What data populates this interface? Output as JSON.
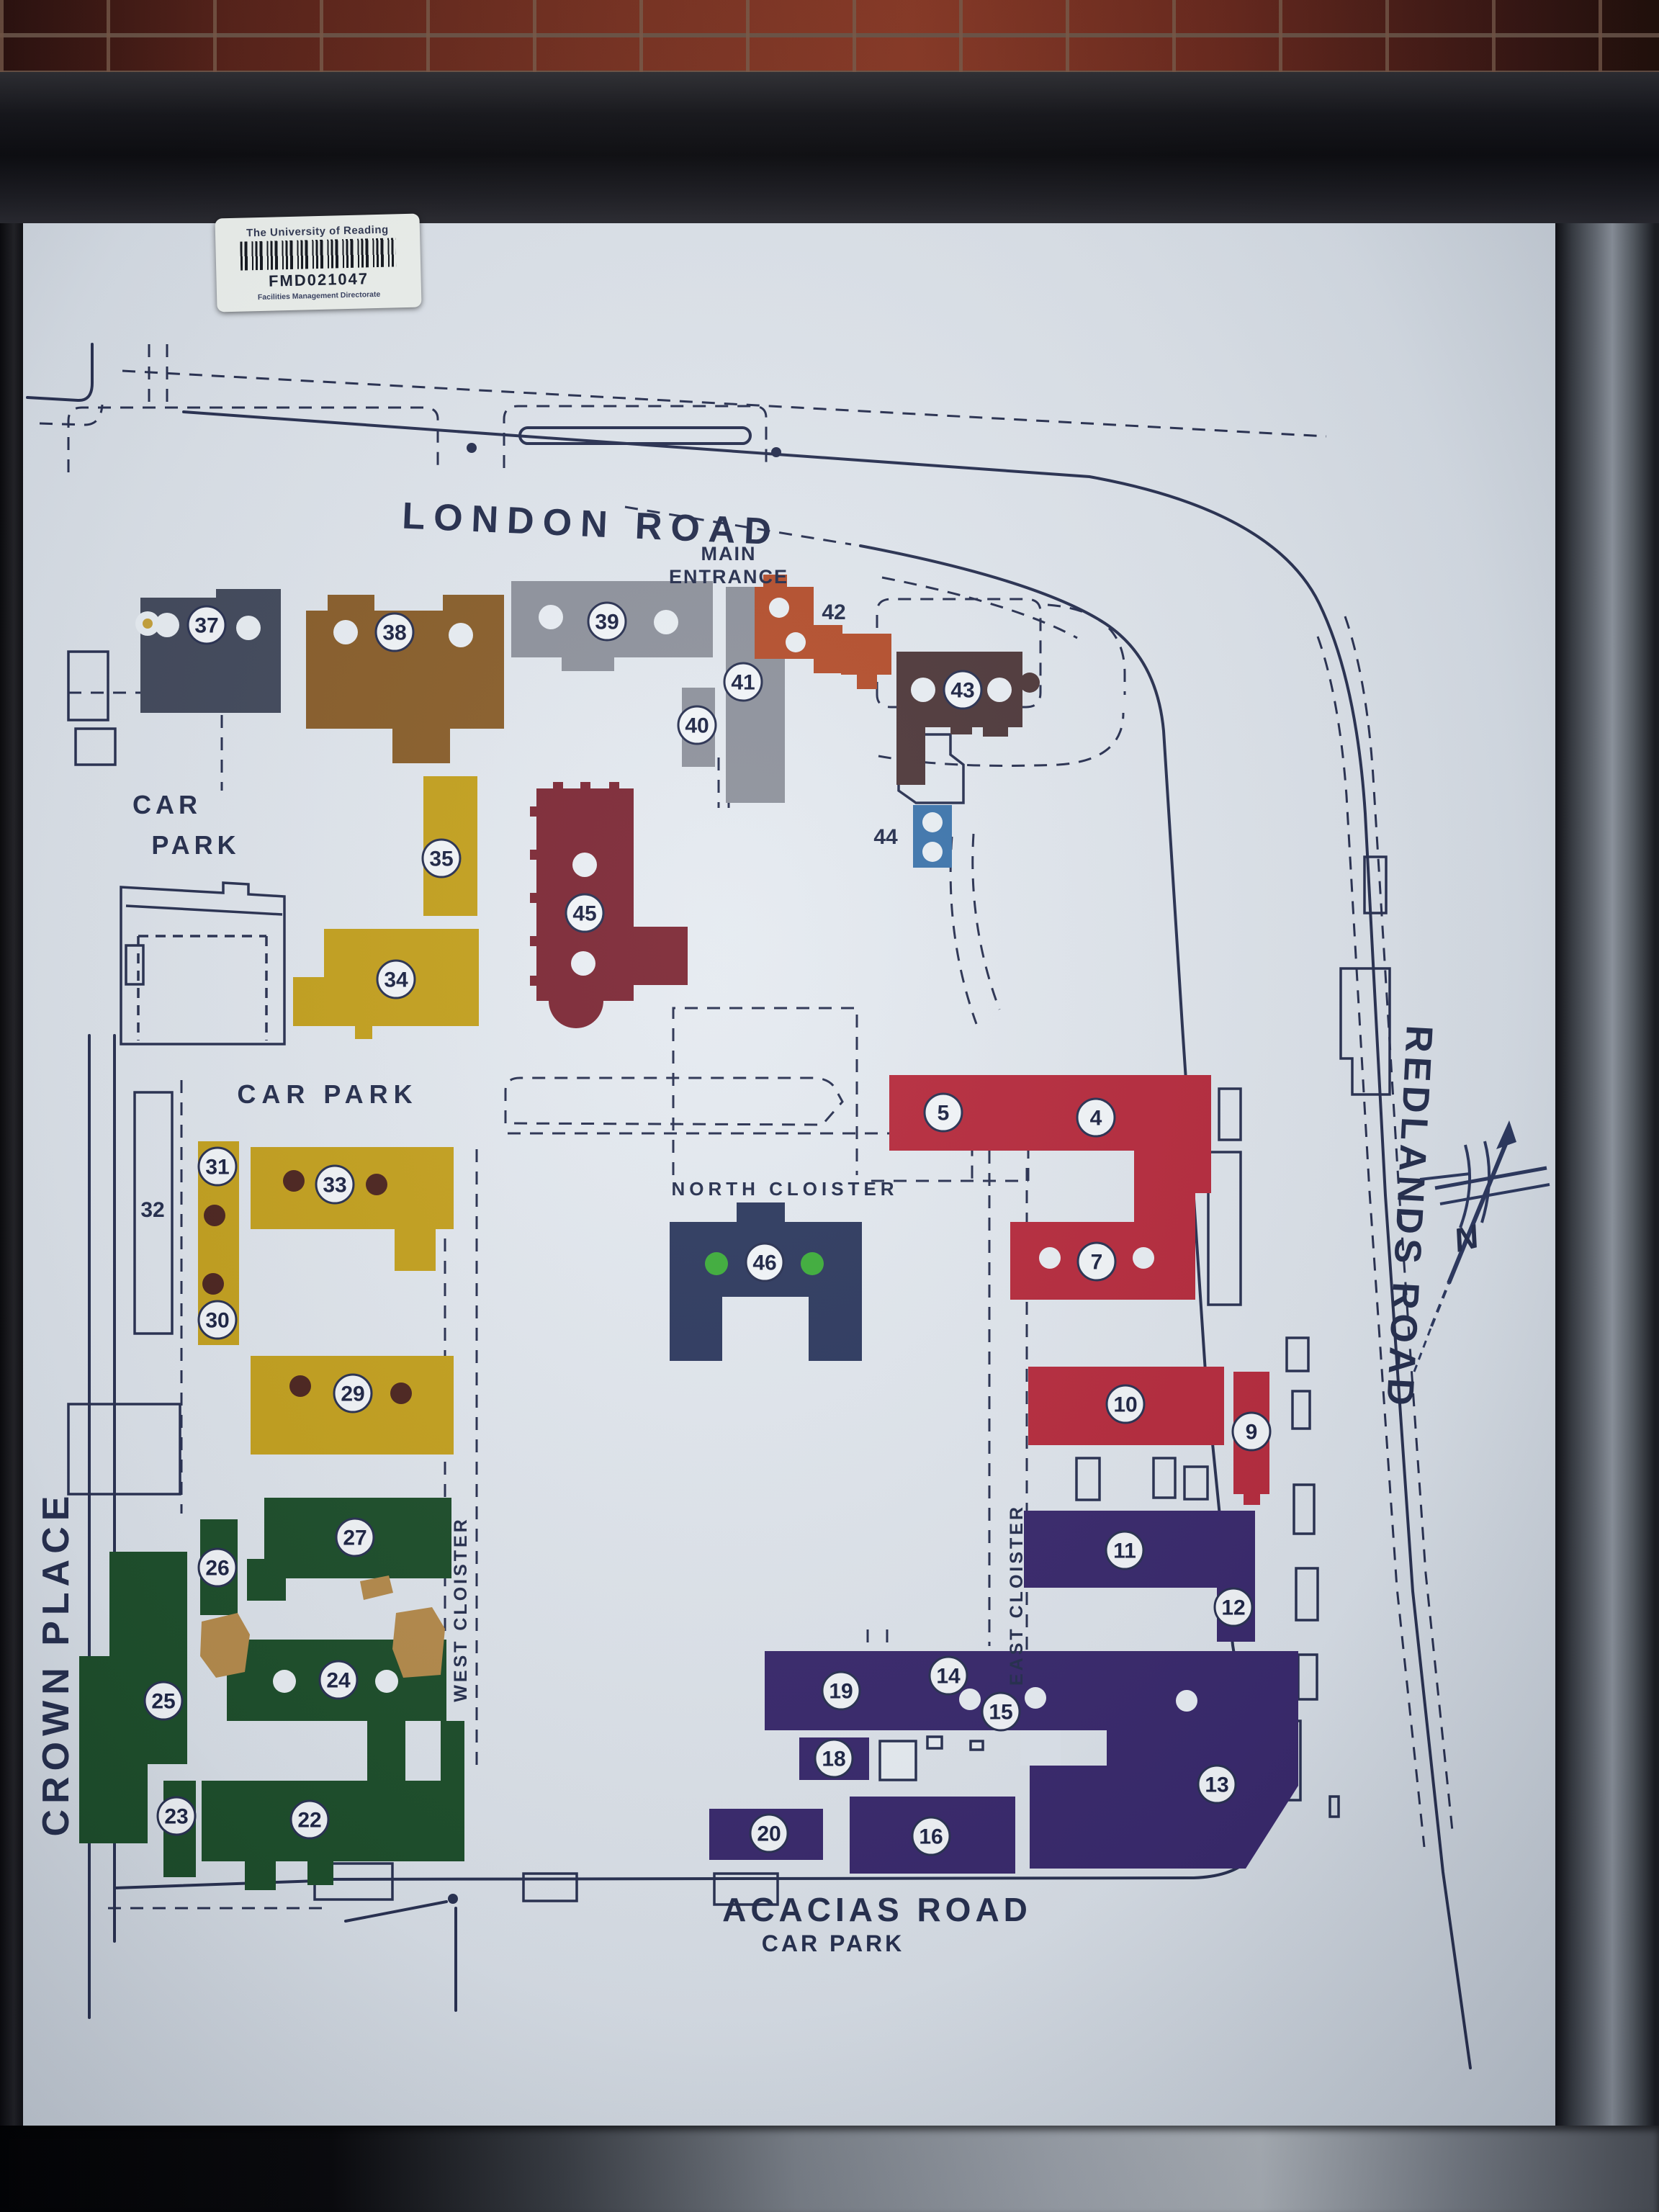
{
  "sticker": {
    "org": "The University of Reading",
    "code": "FMD021047",
    "dept": "Facilities Management Directorate"
  },
  "map": {
    "road_names": {
      "london": "LONDON ROAD",
      "crown": "CROWN PLACE",
      "redlands": "REDLANDS ROAD",
      "acacias": "ACACIAS ROAD"
    },
    "labels": {
      "main_entrance_line1": "MAIN",
      "main_entrance_line2": "ENTRANCE",
      "car_park_nw_line1": "CAR",
      "car_park_nw_line2": "PARK",
      "car_park_mid": "CAR PARK",
      "car_park_south": "CAR PARK",
      "north_cloister": "NORTH CLOISTER",
      "west_cloister": "WEST CLOISTER",
      "east_cloister": "EAST CLOISTER"
    },
    "compass_n": "N",
    "nums": {
      "b4": "4",
      "b5": "5",
      "b7": "7",
      "b9": "9",
      "b10": "10",
      "b11": "11",
      "b12": "12",
      "b13": "13",
      "b14": "14",
      "b15": "15",
      "b16": "16",
      "b18": "18",
      "b19": "19",
      "b20": "20",
      "b22": "22",
      "b23": "23",
      "b24": "24",
      "b25": "25",
      "b26": "26",
      "b27": "27",
      "b29": "29",
      "b30": "30",
      "b31": "31",
      "b32": "32",
      "b33": "33",
      "b34": "34",
      "b35": "35",
      "b37": "37",
      "b38": "38",
      "b39": "39",
      "b40": "40",
      "b41": "41",
      "b42": "42",
      "b43": "43",
      "b44": "44",
      "b45": "45",
      "b46": "46"
    }
  },
  "colors": {
    "ink": "#2a3252",
    "board": "#dfe5ec",
    "navy37": "#434a5c",
    "brown38": "#8a5f2b",
    "gray39": "#8f939d",
    "orange42": "#b5502e",
    "darkbrown43": "#503a3c",
    "blue44": "#3f76ad",
    "yellow": "#c4a11f",
    "darkred45": "#7e2a37",
    "navy46": "#2f3b60",
    "crimson": "#b72c3e",
    "purple": "#3a2a6d",
    "green": "#1e4f2b",
    "pin_dark": "#4d2620",
    "pin_green": "#3fae3c",
    "pin_yellow": "#c6a23c",
    "tan_damage": "#b58b4c"
  }
}
